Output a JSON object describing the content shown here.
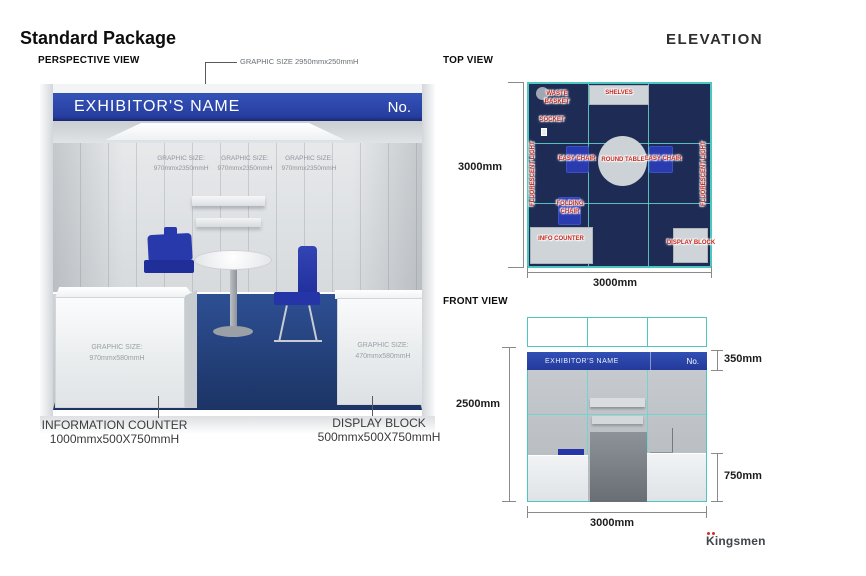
{
  "page": {
    "title": "Standard Package",
    "elevation_label": "ELEVATION",
    "brand": "Kingsmen"
  },
  "colors": {
    "fascia_blue": "#2a43a7",
    "plan_navy": "#1e2c55",
    "teal": "#4ec6c0",
    "label_red": "#c5261d",
    "carpet_blue": "#24407c",
    "chair_blue": "#2a3bb0"
  },
  "perspective": {
    "section_label": "PERSPECTIVE VIEW",
    "header_graphic_callout": "GRAPHIC SIZE 2950mmx250mmH",
    "fascia": {
      "exhibitor_name": "EXHIBITOR'S NAME",
      "number_label": "No."
    },
    "wall_graphics": [
      {
        "line1": "GRAPHIC SIZE:",
        "line2": "970mmx2350mmH"
      },
      {
        "line1": "GRAPHIC SIZE:",
        "line2": "970mmx2350mmH"
      },
      {
        "line1": "GRAPHIC SIZE:",
        "line2": "970mmx2350mmH"
      }
    ],
    "counter_graphic": {
      "line1": "GRAPHIC SIZE:",
      "line2": "970mmx580mmH"
    },
    "display_graphic": {
      "line1": "GRAPHIC SIZE:",
      "line2": "470mmx580mmH"
    },
    "info_counter_callout": {
      "line1": "INFORMATION COUNTER",
      "line2": "1000mmx500X750mmH"
    },
    "display_block_callout": {
      "line1": "DISPLAY BLOCK",
      "line2": "500mmx500X750mmH"
    }
  },
  "top_view": {
    "section_label": "TOP VIEW",
    "dim_left": "3000mm",
    "dim_bottom": "3000mm",
    "labels": {
      "waste_basket": "WASTE BASKET",
      "socket": "SOCKET",
      "shelves": "SHELVES",
      "easy_chair_left": "EASY CHAIR",
      "easy_chair_right": "EASY CHAIR",
      "round_table": "ROUND TABLE",
      "folding_chair": "FOLDING CHAIR",
      "info_counter": "INFO COUNTER",
      "display_block": "DISPLAY BLOCK",
      "fluorescent_left": "FLUORESCENT LIGHT",
      "fluorescent_right": "FLUORESCENT LIGHT"
    }
  },
  "front_view": {
    "section_label": "FRONT VIEW",
    "fascia": {
      "exhibitor_name": "EXHIBITOR'S NAME",
      "number_label": "No."
    },
    "dim_height": "2500mm",
    "dim_fascia_height": "350mm",
    "dim_counter_height": "750mm",
    "dim_width": "3000mm"
  }
}
